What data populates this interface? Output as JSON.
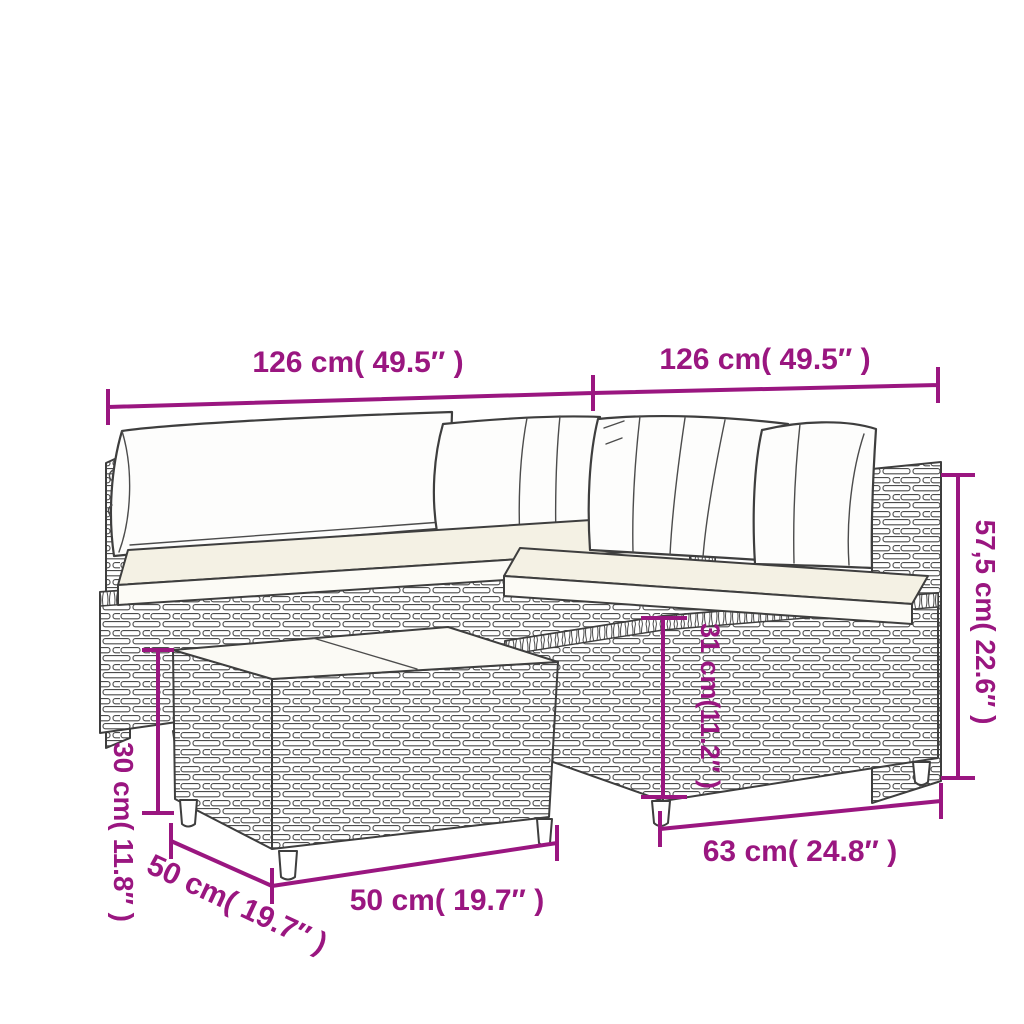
{
  "diagram": {
    "background_color": "#ffffff",
    "accent_color": "#9A1680",
    "outline_color": "#3e3e3e",
    "dimensions": {
      "left_section_width": "126 cm( 49.5″ )",
      "right_section_width": "126 cm( 49.5″ )",
      "backrest_height": "57,5 cm( 22.6″ )",
      "seat_height": "31 cm(11.2″ )",
      "seat_depth": "63 cm( 24.8″ )",
      "table_width": "50 cm( 19.7″ )",
      "table_height": "30 cm( 11.8″ )",
      "table_depth": "50 cm( 19.7″ )"
    }
  }
}
